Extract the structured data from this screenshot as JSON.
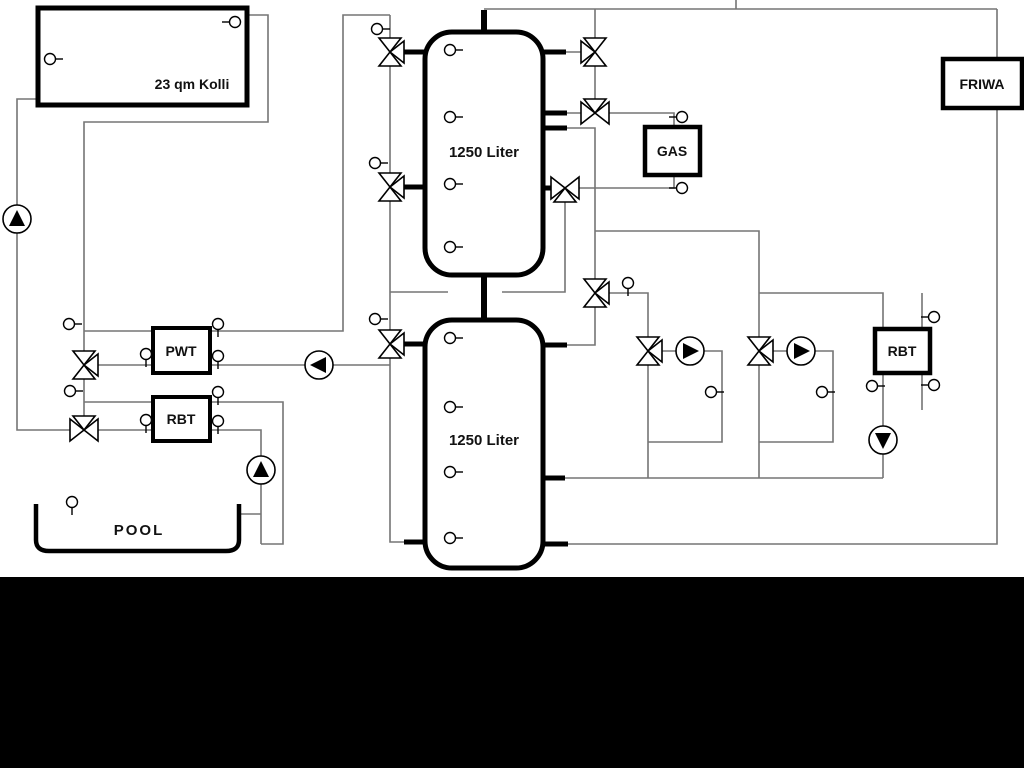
{
  "window": {
    "width": 1024,
    "height": 768,
    "background": "#ffffff",
    "bottom_bar_color": "#000000"
  },
  "colors": {
    "pipe": "#757575",
    "component_stroke": "#000000",
    "component_fill": "#ffffff",
    "label_text": "#111111"
  },
  "labels": {
    "collector": "23 qm Kolli",
    "upper_tank": "1250 Liter",
    "lower_tank": "1250 Liter",
    "pwt": "PWT",
    "rbt_left": "RBT",
    "gas": "GAS",
    "friwa": "FRIWA",
    "rbt_right": "RBT",
    "pool": "POOL"
  },
  "components": {
    "valves": [
      {
        "x": 390,
        "y": 52,
        "type": "v",
        "wing": "right"
      },
      {
        "x": 390,
        "y": 187,
        "type": "v",
        "wing": "right"
      },
      {
        "x": 390,
        "y": 344,
        "type": "v",
        "wing": "right"
      },
      {
        "x": 84,
        "y": 365,
        "type": "v",
        "wing": "right"
      },
      {
        "x": 84,
        "y": 430,
        "type": "h",
        "wing": "top"
      },
      {
        "x": 595,
        "y": 52,
        "type": "v",
        "wing": "left"
      },
      {
        "x": 595,
        "y": 113,
        "type": "h",
        "wing": "top"
      },
      {
        "x": 565,
        "y": 188,
        "type": "h",
        "wing": "bottom"
      },
      {
        "x": 595,
        "y": 293,
        "type": "v",
        "wing": "right"
      },
      {
        "x": 648,
        "y": 351,
        "type": "v",
        "wing": "right"
      },
      {
        "x": 759,
        "y": 351,
        "type": "v",
        "wing": "right"
      }
    ],
    "pumps": [
      {
        "x": 17,
        "y": 219,
        "dir": "up"
      },
      {
        "x": 319,
        "y": 365,
        "dir": "left"
      },
      {
        "x": 261,
        "y": 470,
        "dir": "up"
      },
      {
        "x": 690,
        "y": 351,
        "dir": "right"
      },
      {
        "x": 801,
        "y": 351,
        "dir": "right"
      },
      {
        "x": 883,
        "y": 440,
        "dir": "down"
      }
    ],
    "sensors": [
      {
        "x": 50,
        "y": 59,
        "tick": "right"
      },
      {
        "x": 235,
        "y": 22,
        "tick": "left"
      },
      {
        "x": 450,
        "y": 50,
        "tick": "right"
      },
      {
        "x": 450,
        "y": 117,
        "tick": "right"
      },
      {
        "x": 450,
        "y": 184,
        "tick": "right"
      },
      {
        "x": 450,
        "y": 247,
        "tick": "right"
      },
      {
        "x": 450,
        "y": 338,
        "tick": "right"
      },
      {
        "x": 450,
        "y": 407,
        "tick": "right"
      },
      {
        "x": 450,
        "y": 472,
        "tick": "right"
      },
      {
        "x": 450,
        "y": 538,
        "tick": "right"
      },
      {
        "x": 377,
        "y": 29,
        "tick": "right"
      },
      {
        "x": 375,
        "y": 163,
        "tick": "right"
      },
      {
        "x": 375,
        "y": 319,
        "tick": "right"
      },
      {
        "x": 69,
        "y": 324,
        "tick": "right"
      },
      {
        "x": 70,
        "y": 391,
        "tick": "right"
      },
      {
        "x": 146,
        "y": 354,
        "tick": "down"
      },
      {
        "x": 146,
        "y": 420,
        "tick": "down"
      },
      {
        "x": 218,
        "y": 324,
        "tick": "down"
      },
      {
        "x": 218,
        "y": 356,
        "tick": "down"
      },
      {
        "x": 218,
        "y": 392,
        "tick": "down"
      },
      {
        "x": 218,
        "y": 421,
        "tick": "down"
      },
      {
        "x": 682,
        "y": 117,
        "tick": "left"
      },
      {
        "x": 682,
        "y": 188,
        "tick": "left"
      },
      {
        "x": 628,
        "y": 283,
        "tick": "down"
      },
      {
        "x": 711,
        "y": 392,
        "tick": "right"
      },
      {
        "x": 822,
        "y": 392,
        "tick": "right"
      },
      {
        "x": 934,
        "y": 317,
        "tick": "left"
      },
      {
        "x": 934,
        "y": 385,
        "tick": "left"
      },
      {
        "x": 872,
        "y": 386,
        "tick": "right"
      },
      {
        "x": 72,
        "y": 502,
        "tick": "down"
      }
    ]
  }
}
